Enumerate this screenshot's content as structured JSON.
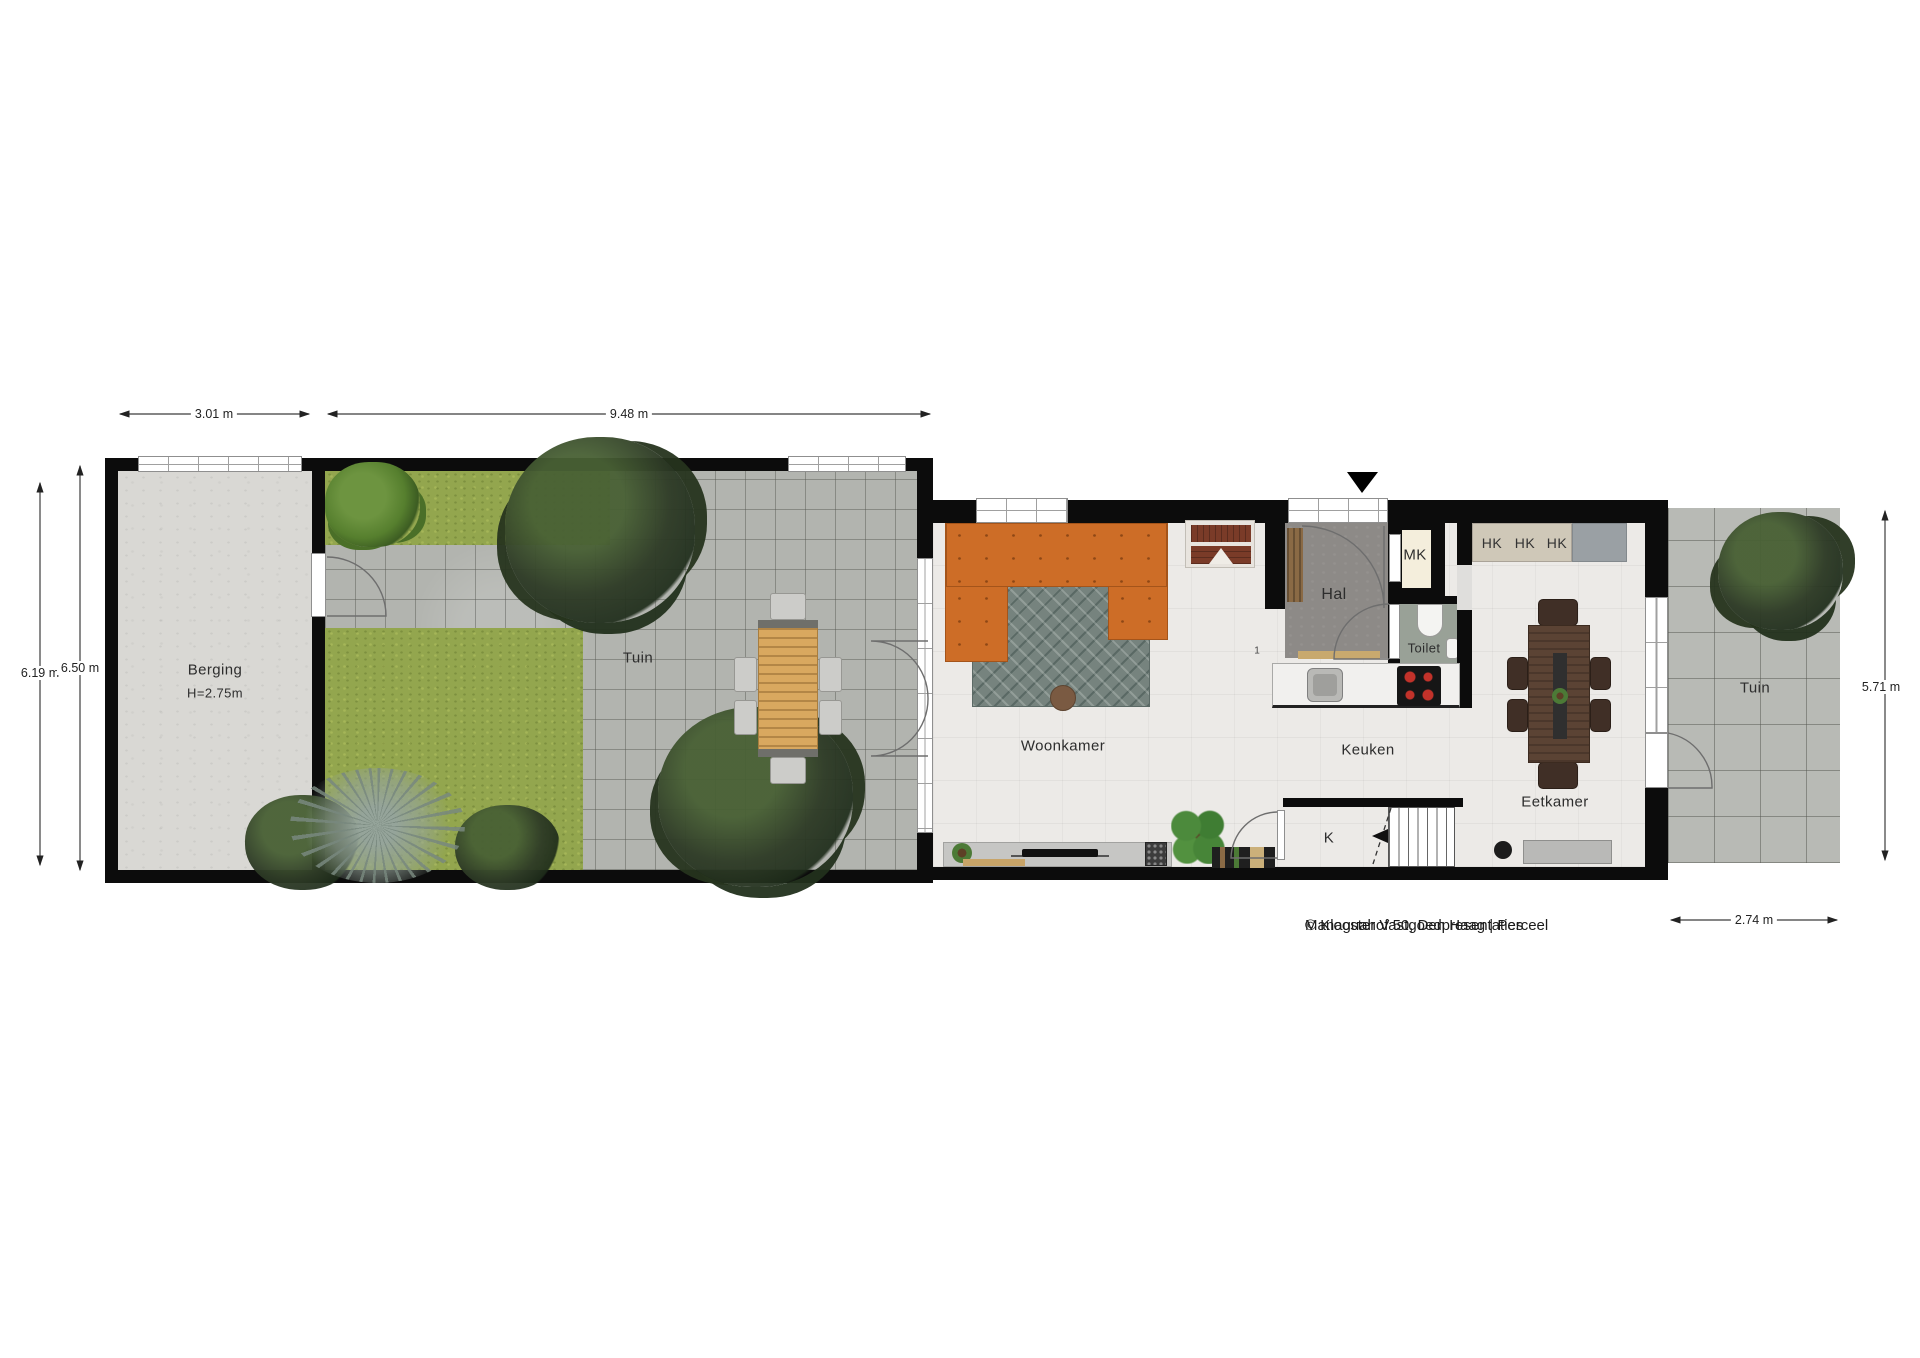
{
  "meta": {
    "address_line": "Managuahof 50, Den Haag | Perceel",
    "copyright_line": "© Klooster Vastgoedpresentaties"
  },
  "dimensions": {
    "berging_width": "3.01 m",
    "garden_width": "9.48 m",
    "left_inner_height": "6.19 m",
    "left_outer_height": "6.50 m",
    "right_garden_height": "5.71 m",
    "right_garden_width": "2.74 m"
  },
  "rooms": {
    "berging": {
      "label": "Berging",
      "ceiling_height": "H=2.75m"
    },
    "garden_left": {
      "label": "Tuin"
    },
    "woonkamer": {
      "label": "Woonkamer"
    },
    "hal": {
      "label": "Hal"
    },
    "mk": {
      "label": "MK"
    },
    "toilet": {
      "label": "Toilet"
    },
    "keuken": {
      "label": "Keuken"
    },
    "eetkamer": {
      "label": "Eetkamer"
    },
    "stair_closet": {
      "label": "K"
    },
    "garden_right": {
      "label": "Tuin"
    },
    "hk_labels": [
      "HK",
      "HK",
      "HK"
    ]
  },
  "annotations": {
    "door_note": "1"
  },
  "colors": {
    "wall": "#0c0c0c",
    "grass": "#93a64e",
    "stone_left": "#b2b4af",
    "stone_right": "#b8bab5",
    "concrete": "#d9d8d4",
    "house_floor": "#eceae7",
    "hal_floor": "#8d8a87",
    "toilet_floor": "#99a197",
    "mk_floor": "#f4eedc",
    "sofa_orange": "#cd6d27",
    "rug_teal": "#76837e",
    "wood_light": "#d9a85f",
    "wood_dark": "#5b4334",
    "red_chair": "#7a3b28",
    "tree_dark": "#2e3b26"
  }
}
